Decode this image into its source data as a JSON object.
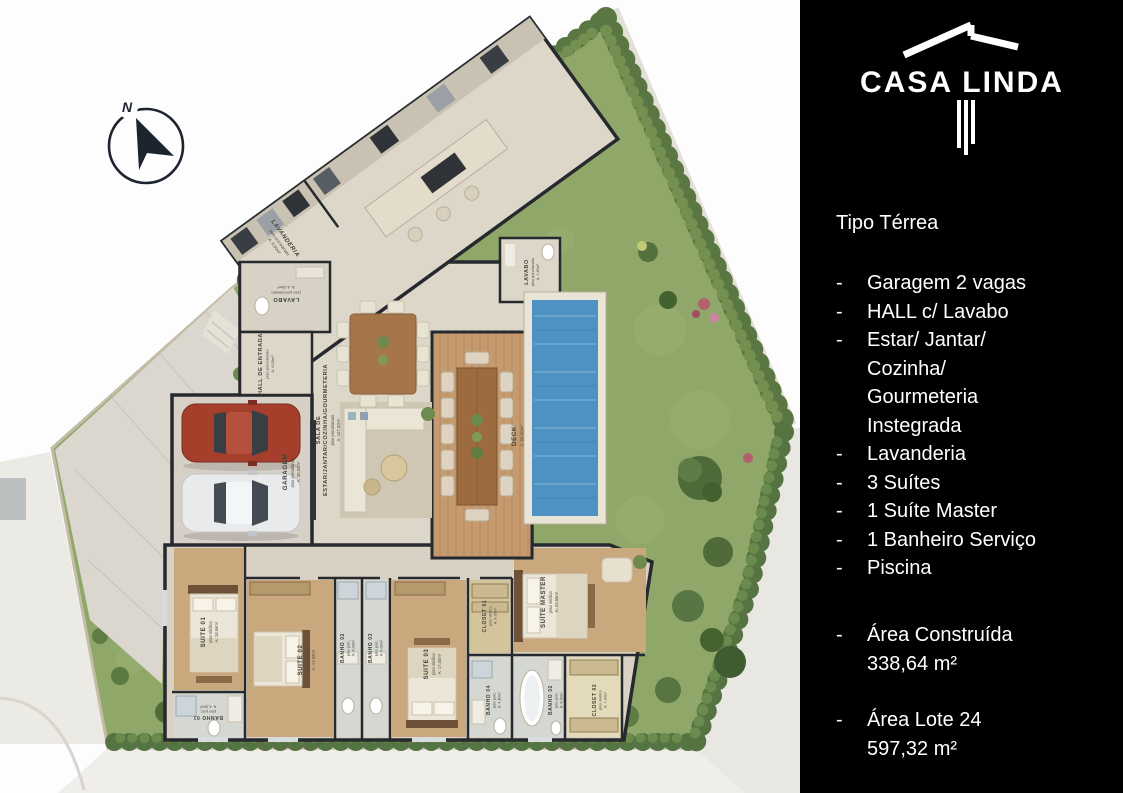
{
  "sidebar": {
    "brand": "CASA LINDA",
    "type_label": "Tipo Térrea",
    "features": [
      "Garagem 2 vagas",
      "HALL c/ Lavabo",
      "Estar/ Jantar/\nCozinha/\nGourmeteria\nInstegrada",
      "Lavanderia",
      "3 Suítes",
      "1 Suíte Master",
      "1 Banheiro Serviço",
      "Piscina"
    ],
    "areas": [
      {
        "text": "Área Construída\n338,64 m²"
      },
      {
        "text": "Área Lote 24\n 597,32 m²"
      }
    ]
  },
  "plan": {
    "compass": {
      "label": "N"
    },
    "rooms": {
      "lavanderia": {
        "name": "LAVANDERIA",
        "floor": "piso porcelanato",
        "area": "A. 8,60m²"
      },
      "lavabo": {
        "name": "LAVABO",
        "floor": "piso porcelanato",
        "area": "A. 4,00m²"
      },
      "hall": {
        "name": "HALL DE ENTRADA",
        "floor": "piso porcelanato",
        "area": "A. 6,00m²"
      },
      "garagem": {
        "name": "GARAGEM",
        "floor": "piso porcelanato",
        "area": "A. 35,50m²"
      },
      "sala": {
        "name_line1": "SALA DE",
        "name_line2": "ESTAR/JANTAR/COZINHA/GOURMETERIA",
        "floor": "piso porcelanato",
        "area": "A. 107,50m²"
      },
      "lavabo_piscina": {
        "name": "LAVABO",
        "floor": "piso porcelanato",
        "area": "A. 1,60m²"
      },
      "deck": {
        "name": "DECK",
        "area": "A. 50,00m²"
      },
      "suite01": {
        "name": "SUITE 01",
        "floor": "piso vinílico",
        "area": "A: 18,65m²"
      },
      "banho01": {
        "name": "BANHO 01",
        "floor": "piso porc.",
        "area": "A. 4,30m²"
      },
      "suite02": {
        "name": "SUITE 02",
        "floor": "piso vinílico",
        "area": "A: 17,00m²"
      },
      "banho02": {
        "name": "BANHO 02",
        "floor": "piso porc.",
        "area": "A: 4,00m²"
      },
      "banho03": {
        "name": "BANHO 03",
        "floor": "piso porc.",
        "area": "A: 4,00m²"
      },
      "suite03": {
        "name": "SUITE 03",
        "floor": "piso vinílico",
        "area": "A: 17,00m²"
      },
      "closet01": {
        "name": "CLOSET 01",
        "floor": "piso vinílico",
        "area": "A: 4,00m²"
      },
      "banho04": {
        "name": "BANHO 04",
        "floor": "piso porc.",
        "area": "A: 4,80m²"
      },
      "suite_master": {
        "name": "SUÍTE MASTER",
        "floor": "piso vinílico",
        "area": "A: 22,50m²"
      },
      "banho_master": {
        "name": "BANHO 02",
        "floor": "piso porc.",
        "area": "A: 6,00m²"
      },
      "closet02": {
        "name": "CLOSET 02",
        "floor": "piso vinílico",
        "area": "A: 7,00m²"
      }
    }
  },
  "colors": {
    "panel_bg": "#000000",
    "panel_text": "#ffffff",
    "grass": "#8fa768",
    "paving": "#dbd7cf",
    "pool_water": "#4e92c3",
    "wall": "#26292d",
    "deck_wood": "#c59a6e",
    "car_red": "#a63e2c",
    "car_silver": "#e9eaec"
  }
}
